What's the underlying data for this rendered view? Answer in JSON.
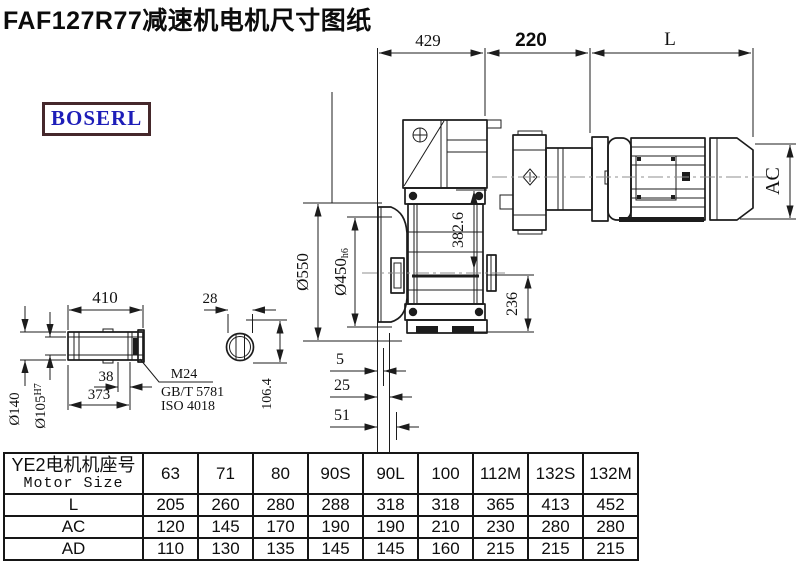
{
  "header": {
    "title": "FAF127R77减速机电机尺寸图纸",
    "logo_text": "BOSERL"
  },
  "drawing": {
    "dim_429": "429",
    "dim_220": "220",
    "dim_L": "L",
    "dim_AC": "AC",
    "dim_550": "Ø550",
    "dim_450_main": "Ø450",
    "dim_450_suffix": "h6",
    "dim_382_6": "382.6",
    "dim_236": "236",
    "dim_410": "410",
    "dim_38": "38",
    "dim_373": "373",
    "dim_140": "Ø140",
    "dim_105_main": "Ø105",
    "dim_105_suffix": "H7",
    "dim_28": "28",
    "dim_106_4": "106.4",
    "dim_5": "5",
    "dim_25": "25",
    "dim_51": "51",
    "note_line1": "M24",
    "note_line2": "GB/T 5781",
    "note_line3": "ISO 4018"
  },
  "table": {
    "row_header_cn": "YE2电机机座号",
    "row_header_en": "Motor Size",
    "columns": [
      "63",
      "71",
      "80",
      "90S",
      "90L",
      "100",
      "112M",
      "132S",
      "132M"
    ],
    "rows": [
      {
        "label": "L",
        "values": [
          "205",
          "260",
          "280",
          "288",
          "318",
          "318",
          "365",
          "413",
          "452"
        ]
      },
      {
        "label": "AC",
        "values": [
          "120",
          "145",
          "170",
          "190",
          "190",
          "210",
          "230",
          "280",
          "280"
        ]
      },
      {
        "label": "AD",
        "values": [
          "110",
          "130",
          "135",
          "145",
          "145",
          "160",
          "215",
          "215",
          "215"
        ]
      }
    ]
  },
  "colors": {
    "line": "#1c1c1c",
    "logo_text": "#1d1db8",
    "logo_border": "#45282b",
    "centerline": "#8f8f8f",
    "background": "#ffffff"
  }
}
